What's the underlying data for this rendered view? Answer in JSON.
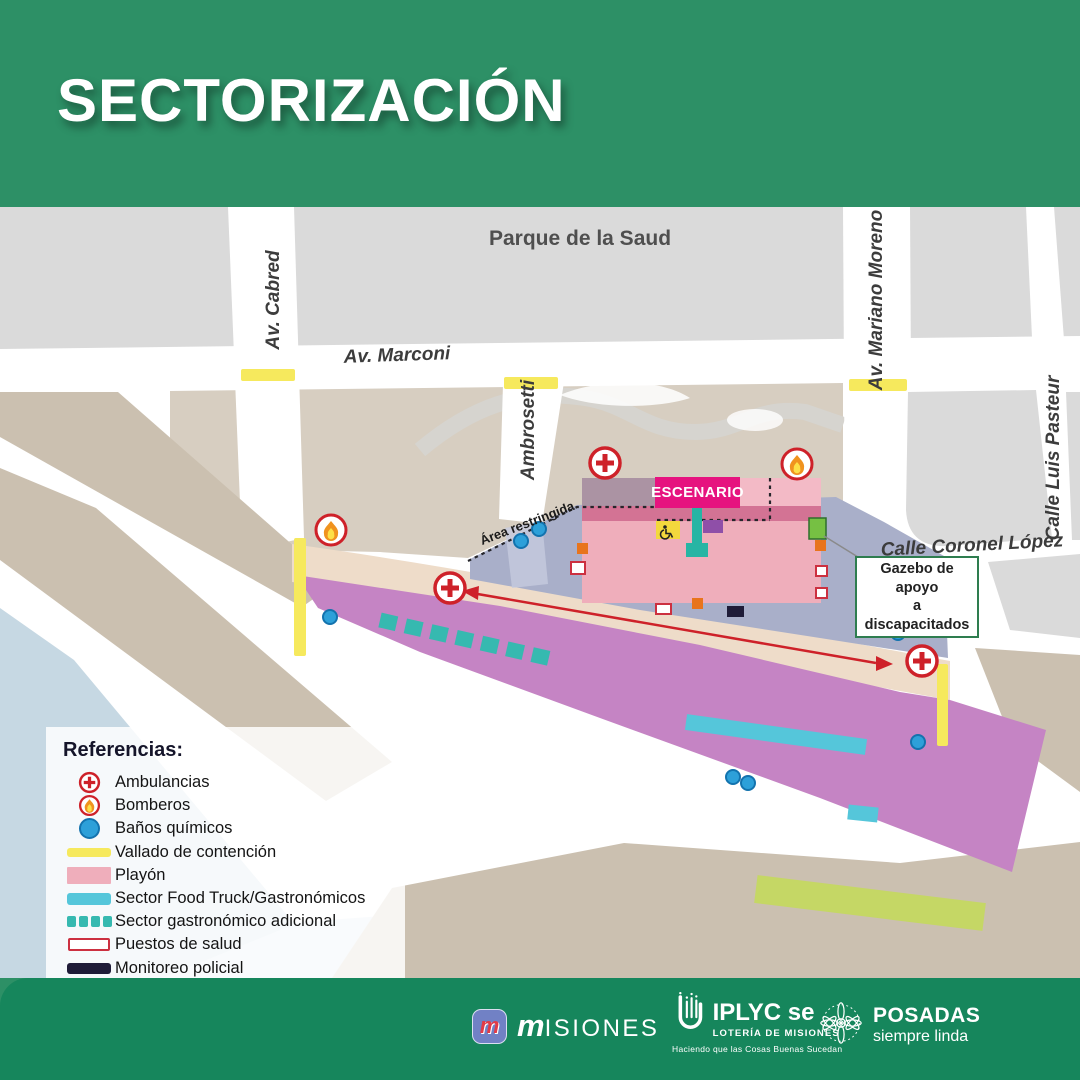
{
  "title": "SECTORIZACIÓN",
  "map": {
    "street_labels": {
      "park": "Parque de la Saud",
      "cabred": "Av. Cabred",
      "marconi": "Av. Marconi",
      "ambrosetti": "Ambrosetti",
      "mariano_moreno": "Av. Mariano Moreno",
      "luis_pasteur": "Calle Luis Pasteur",
      "coronel_lopez": "Calle Coronel López"
    },
    "annotations": {
      "stage": "ESCENARIO",
      "restricted_area": "Área restringida",
      "gazebo_line1": "Gazebo de apoyo",
      "gazebo_line2": "a discapacitados"
    }
  },
  "legend": {
    "heading": "Referencias:",
    "items": [
      {
        "icon": "ambulance-icon",
        "label": "Ambulancias"
      },
      {
        "icon": "fire-icon",
        "label": "Bomberos"
      },
      {
        "icon": "chemical-toilet-icon",
        "label": "Baños químicos"
      },
      {
        "icon": "containment-fence-swatch",
        "label": "Vallado de contención"
      },
      {
        "icon": "esplanade-swatch",
        "label": "Playón"
      },
      {
        "icon": "food-truck-swatch",
        "label": "Sector Food Truck/Gastronómicos"
      },
      {
        "icon": "extra-gastro-swatch",
        "label": "Sector gastronómico adicional"
      },
      {
        "icon": "health-post-swatch",
        "label": "Puestos de salud"
      },
      {
        "icon": "police-monitor-swatch",
        "label": "Monitoreo policial"
      },
      {
        "icon": "hydration-swatch",
        "label": "Zona de hidratación"
      },
      {
        "icon": "bus-parking-swatch",
        "label": "Estacionamiento de colectivos"
      },
      {
        "icon": "press-swatch",
        "label": "Prensa"
      }
    ]
  },
  "footer": {
    "misiones_mark": "m",
    "misiones_word_initial": "m",
    "misiones_wordmark": "ISIONES",
    "iplyc_name": "IPLYC se",
    "iplyc_subtitle": "LOTERÍA DE MISIONES",
    "iplyc_tagline": "Haciendo que las Cosas Buenas Sucedan",
    "posadas_name": "POSADAS",
    "posadas_tagline": "siempre linda"
  },
  "colors": {
    "header_green": "#2d9066",
    "footer_green": "#16865c",
    "stage_magenta": "#e6137f",
    "playon_pink": "#efaebb",
    "prensa_purple": "#c584c4",
    "foodtruck_cyan": "#55c6da",
    "gastro_teal": "#36b9b0",
    "vallado_yellow": "#f6e95d",
    "hydration_orange": "#e8741c",
    "police_navy": "#1f1c38",
    "parking_green": "#c5d765",
    "toilets_blue": "#2da0d9",
    "emergency_red": "#ce2129"
  }
}
